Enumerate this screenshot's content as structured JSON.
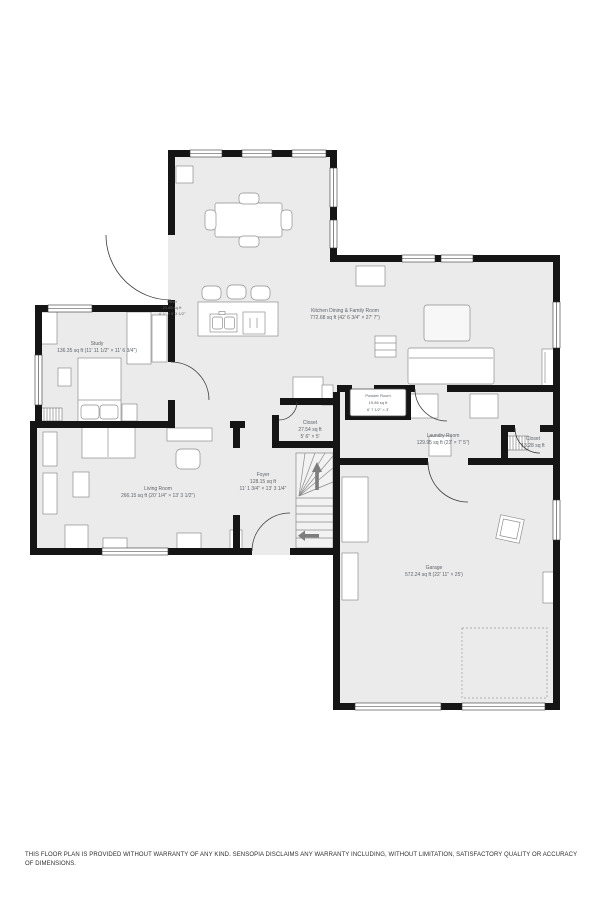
{
  "rooms": {
    "kitchen": {
      "name": "Kitchen Dining & Family Room",
      "area": "772.68 sq ft (42' 6 3/4\" × 27' 7\")"
    },
    "study": {
      "name": "Study",
      "area": "136.35 sq ft (11' 11 1/2\" × 11' 6 3/4\")"
    },
    "living_room": {
      "name": "Living Room",
      "area": "266.15 sq ft (20' 1/4\" × 13' 3 1/2\")"
    },
    "foyer": {
      "name": "Foyer",
      "area": "128.15 sq ft",
      "dims": "11' 1 3/4\" × 13' 3 1/4\""
    },
    "closet_center": {
      "name": "Closet",
      "area": "27.54 sq ft",
      "dims": "5' 6\" × 5'"
    },
    "powder_room": {
      "name": "Powder Room",
      "area": "19.86 sq ft",
      "dims": "6' 7 1/2\" × 3'"
    },
    "laundry_room": {
      "name": "Laundry Room",
      "area": "129.95 sq ft (23' × 7' 5\")"
    },
    "closet_right": {
      "name": "Closet",
      "area": "13.28 sq ft"
    },
    "garage": {
      "name": "Garage",
      "area": "572.24 sq ft (22' 11\" × 25')"
    },
    "other": {
      "name": "Other",
      "area": "21.65 sq ft",
      "dims": "4' 1\" × 5' 3 1/2\""
    }
  },
  "disclaimer": "THIS FLOOR PLAN IS PROVIDED WITHOUT WARRANTY OF ANY KIND. SENSOPIA DISCLAIMS ANY WARRANTY INCLUDING, WITHOUT LIMITATION, SATISFACTORY QUALITY OR ACCURACY OF DIMENSIONS.",
  "colors": {
    "floor": "#ebebeb",
    "wall": "#151515",
    "furniture_stroke": "#8f8f8f",
    "label_text": "#5f6368",
    "arrow": "#7d7d7d"
  }
}
